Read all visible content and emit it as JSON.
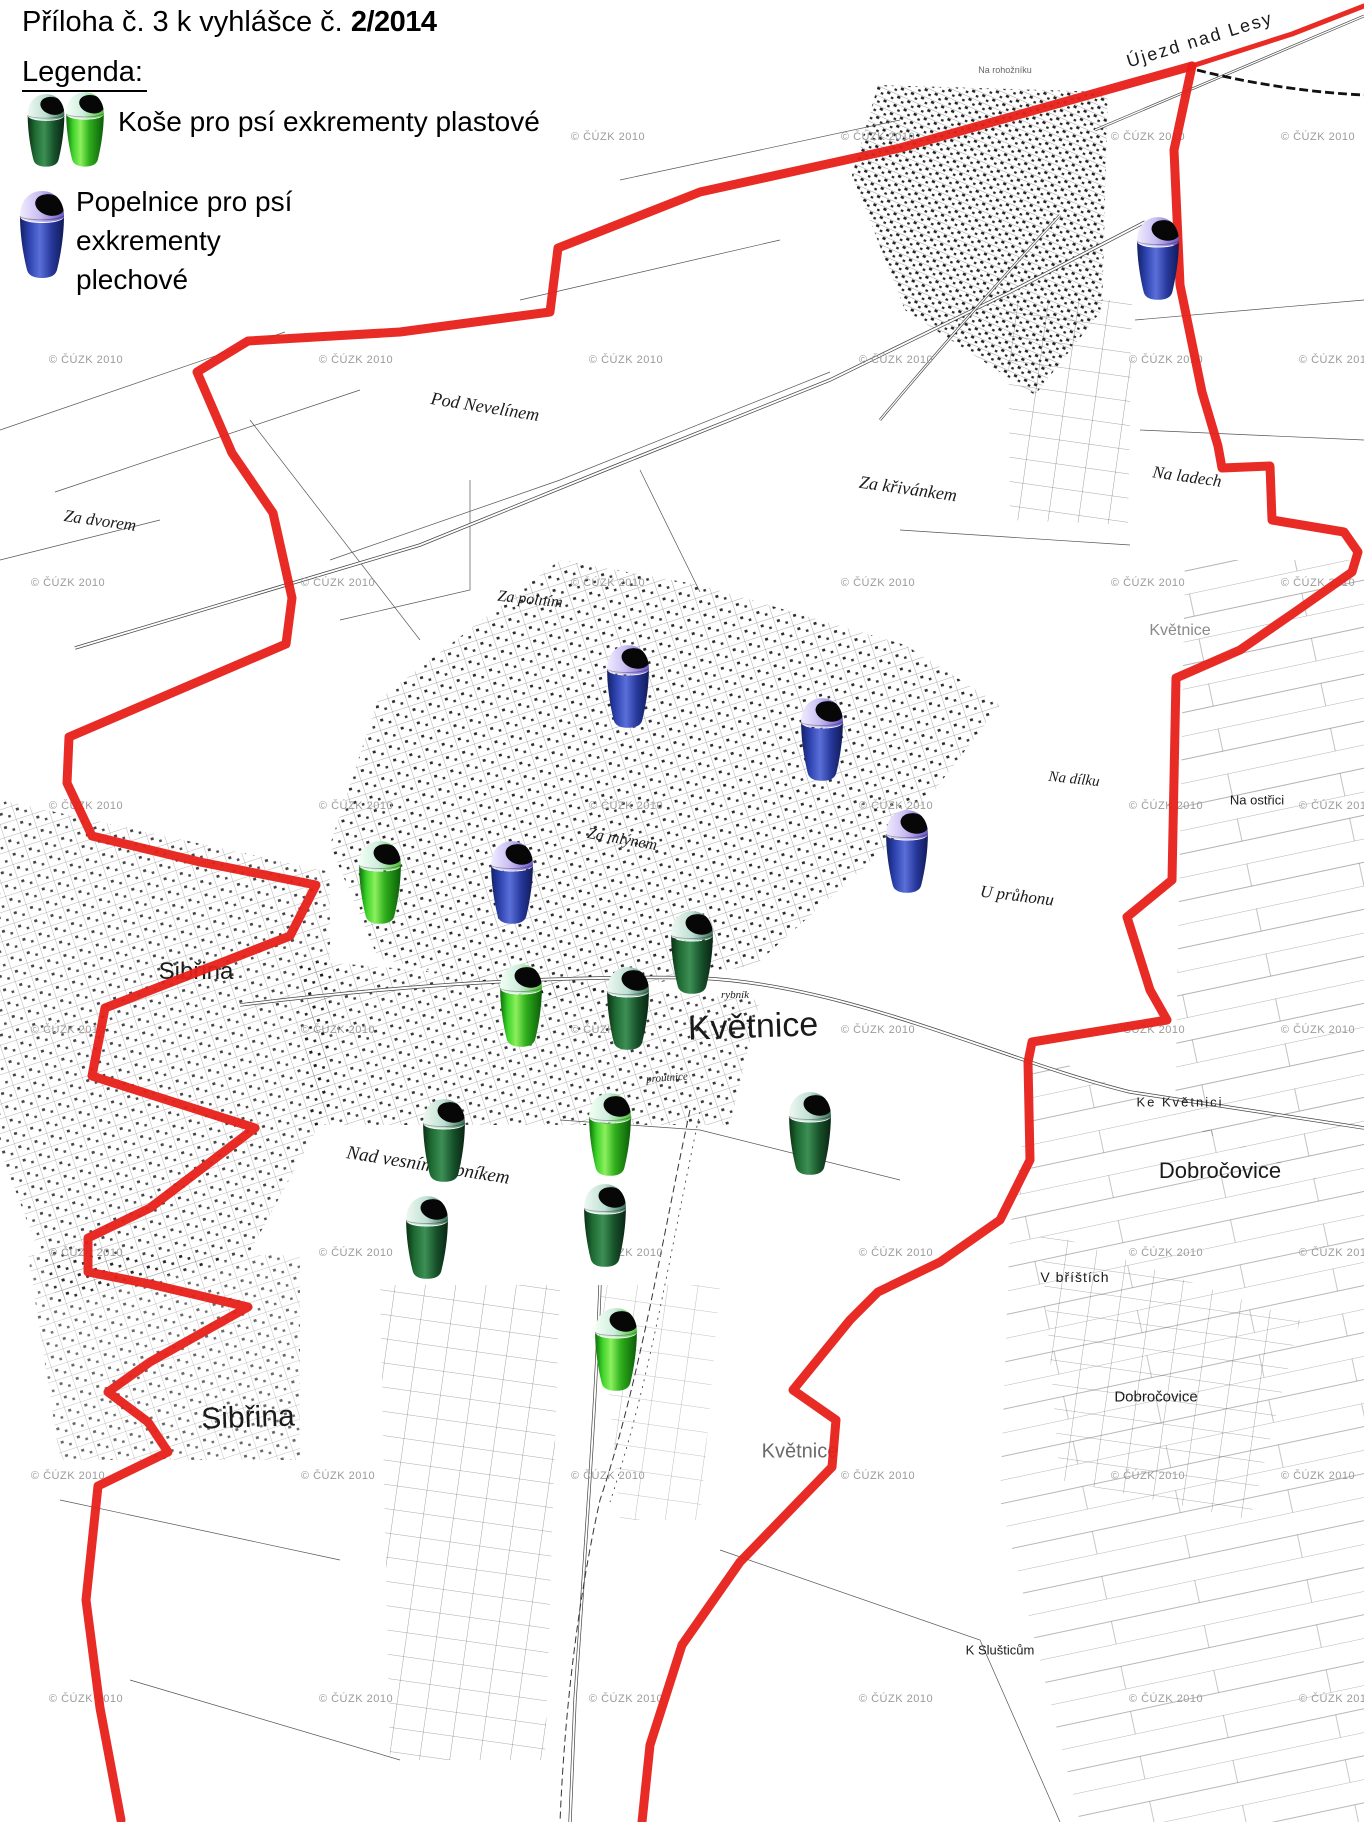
{
  "title": {
    "prefix": "Příloha č. 3 k vyhlášce č.",
    "number": "2/2014"
  },
  "legend": {
    "heading": "Legenda:",
    "items": [
      {
        "label": "Koše pro psí exkrementy plastové",
        "bin_colors": [
          "darkgreen",
          "green"
        ]
      },
      {
        "lines": [
          "Popelnice pro psí",
          "exkrementy",
          "plechové"
        ],
        "bin_colors": [
          "blue"
        ]
      }
    ]
  },
  "map": {
    "watermark": {
      "text": "© ČÚZK 2010",
      "rows": [
        137,
        360,
        583,
        806,
        1030,
        1253,
        1476,
        1699
      ],
      "cols": [
        68,
        338,
        608,
        878,
        1148,
        1318
      ]
    },
    "colors": {
      "boundary_red": "#e8201a",
      "bin_green": "#2fb82a",
      "bin_dark_green": "#1d5c2b",
      "bin_blue": "#2b3fa8"
    },
    "labels": [
      {
        "text": "Újezd nad Lesy",
        "x": 1200,
        "y": 40,
        "size": 18,
        "rot": -17,
        "ls": 2,
        "font": "sans"
      },
      {
        "text": "Na rohožníku",
        "x": 1005,
        "y": 70,
        "size": 9,
        "rot": 0,
        "color": "#666",
        "font": "sans"
      },
      {
        "text": "Pod Nevelínem",
        "x": 485,
        "y": 407,
        "size": 18,
        "rot": 9,
        "font": "serif-i"
      },
      {
        "text": "Za křivánkem",
        "x": 908,
        "y": 489,
        "size": 18,
        "rot": 8,
        "font": "serif-i"
      },
      {
        "text": "Na ladech",
        "x": 1187,
        "y": 477,
        "size": 17,
        "rot": 8,
        "font": "serif-i"
      },
      {
        "text": "Za dvorem",
        "x": 100,
        "y": 521,
        "size": 17,
        "rot": 8,
        "font": "serif-i"
      },
      {
        "text": "Za polním",
        "x": 530,
        "y": 600,
        "size": 16,
        "rot": 6,
        "font": "serif-i"
      },
      {
        "text": "Květnice",
        "x": 1180,
        "y": 631,
        "size": 16,
        "rot": 0,
        "color": "#8a8a8a",
        "font": "sans"
      },
      {
        "text": "Na dílku",
        "x": 1074,
        "y": 780,
        "size": 15,
        "rot": 6,
        "font": "serif-i"
      },
      {
        "text": "Na ostřici",
        "x": 1257,
        "y": 800,
        "size": 13,
        "rot": 0,
        "font": "sans"
      },
      {
        "text": "Za mlýnem",
        "x": 622,
        "y": 840,
        "size": 16,
        "rot": 10,
        "font": "serif-i"
      },
      {
        "text": "U průhonu",
        "x": 1017,
        "y": 896,
        "size": 17,
        "rot": 7,
        "font": "serif-i"
      },
      {
        "text": "Sibřina",
        "x": 196,
        "y": 972,
        "size": 24,
        "rot": 0,
        "font": "sans"
      },
      {
        "text": "rybník",
        "x": 735,
        "y": 995,
        "size": 11,
        "rot": 0,
        "font": "serif-i"
      },
      {
        "text": "Květnice",
        "x": 753,
        "y": 1027,
        "size": 34,
        "rot": -2,
        "font": "sans"
      },
      {
        "text": "proutnice",
        "x": 667,
        "y": 1078,
        "size": 11,
        "rot": -4,
        "font": "serif-i"
      },
      {
        "text": "Ke Květnici",
        "x": 1180,
        "y": 1102,
        "size": 13,
        "rot": 0,
        "ls": 2,
        "font": "sans"
      },
      {
        "text": "Nad vesním rybníkem",
        "x": 428,
        "y": 1166,
        "size": 19,
        "rot": 9,
        "font": "serif-i"
      },
      {
        "text": "Dobročovice",
        "x": 1220,
        "y": 1171,
        "size": 22,
        "rot": 0,
        "font": "sans"
      },
      {
        "text": "V bříštích",
        "x": 1075,
        "y": 1277,
        "size": 14,
        "rot": 0,
        "ls": 1,
        "font": "sans"
      },
      {
        "text": "Dobročovice",
        "x": 1156,
        "y": 1397,
        "size": 15,
        "rot": 0,
        "font": "sans"
      },
      {
        "text": "Sibřina",
        "x": 248,
        "y": 1418,
        "size": 30,
        "rot": -2,
        "font": "sans"
      },
      {
        "text": "Květnice",
        "x": 800,
        "y": 1452,
        "size": 20,
        "rot": 0,
        "color": "#6a6a6a",
        "font": "sans"
      },
      {
        "text": "K Slušticům",
        "x": 1000,
        "y": 1650,
        "size": 13,
        "rot": 0,
        "font": "sans"
      }
    ],
    "bins": [
      {
        "x": 1158,
        "y": 258,
        "color": "blue"
      },
      {
        "x": 628,
        "y": 686,
        "color": "blue"
      },
      {
        "x": 822,
        "y": 739,
        "color": "blue"
      },
      {
        "x": 907,
        "y": 851,
        "color": "blue"
      },
      {
        "x": 380,
        "y": 882,
        "color": "green"
      },
      {
        "x": 512,
        "y": 882,
        "color": "blue"
      },
      {
        "x": 692,
        "y": 952,
        "color": "darkgreen"
      },
      {
        "x": 521,
        "y": 1005,
        "color": "green"
      },
      {
        "x": 628,
        "y": 1008,
        "color": "darkgreen"
      },
      {
        "x": 610,
        "y": 1134,
        "color": "green"
      },
      {
        "x": 444,
        "y": 1140,
        "color": "darkgreen"
      },
      {
        "x": 810,
        "y": 1133,
        "color": "darkgreen"
      },
      {
        "x": 605,
        "y": 1225,
        "color": "darkgreen"
      },
      {
        "x": 427,
        "y": 1237,
        "color": "darkgreen"
      },
      {
        "x": 616,
        "y": 1349,
        "color": "green"
      }
    ],
    "boundary": [
      {
        "width": 5,
        "points": [
          [
            1364,
            6
          ],
          [
            1292,
            34
          ],
          [
            1192,
            66
          ]
        ]
      },
      {
        "width": 9,
        "points": [
          [
            1192,
            66
          ],
          [
            1174,
            150
          ],
          [
            1180,
            285
          ],
          [
            1202,
            392
          ],
          [
            1218,
            446
          ],
          [
            1222,
            468
          ],
          [
            1270,
            466
          ],
          [
            1272,
            520
          ],
          [
            1344,
            532
          ],
          [
            1358,
            552
          ],
          [
            1352,
            572
          ],
          [
            1295,
            612
          ],
          [
            1240,
            650
          ],
          [
            1176,
            678
          ],
          [
            1172,
            880
          ],
          [
            1127,
            917
          ],
          [
            1150,
            990
          ],
          [
            1167,
            1020
          ],
          [
            1032,
            1042
          ],
          [
            1028,
            1062
          ],
          [
            1030,
            1160
          ],
          [
            1000,
            1220
          ],
          [
            940,
            1262
          ],
          [
            878,
            1292
          ],
          [
            850,
            1320
          ],
          [
            793,
            1390
          ],
          [
            836,
            1420
          ],
          [
            832,
            1467
          ],
          [
            800,
            1500
          ],
          [
            740,
            1562
          ],
          [
            682,
            1645
          ],
          [
            650,
            1745
          ],
          [
            642,
            1822
          ]
        ]
      },
      {
        "width": 9,
        "points": [
          [
            1192,
            66
          ],
          [
            900,
            148
          ],
          [
            700,
            192
          ],
          [
            558,
            248
          ],
          [
            550,
            312
          ],
          [
            400,
            332
          ],
          [
            248,
            341
          ],
          [
            197,
            372
          ],
          [
            232,
            453
          ],
          [
            273,
            513
          ],
          [
            292,
            598
          ],
          [
            286,
            644
          ],
          [
            69,
            737
          ],
          [
            67,
            783
          ],
          [
            92,
            836
          ],
          [
            200,
            862
          ],
          [
            316,
            885
          ],
          [
            290,
            936
          ],
          [
            105,
            1008
          ],
          [
            92,
            1076
          ],
          [
            255,
            1128
          ],
          [
            150,
            1208
          ],
          [
            88,
            1238
          ],
          [
            88,
            1272
          ],
          [
            150,
            1284
          ],
          [
            248,
            1307
          ],
          [
            150,
            1362
          ],
          [
            108,
            1392
          ],
          [
            148,
            1422
          ],
          [
            168,
            1452
          ],
          [
            98,
            1486
          ],
          [
            86,
            1600
          ],
          [
            100,
            1708
          ],
          [
            121,
            1820
          ]
        ]
      }
    ]
  }
}
